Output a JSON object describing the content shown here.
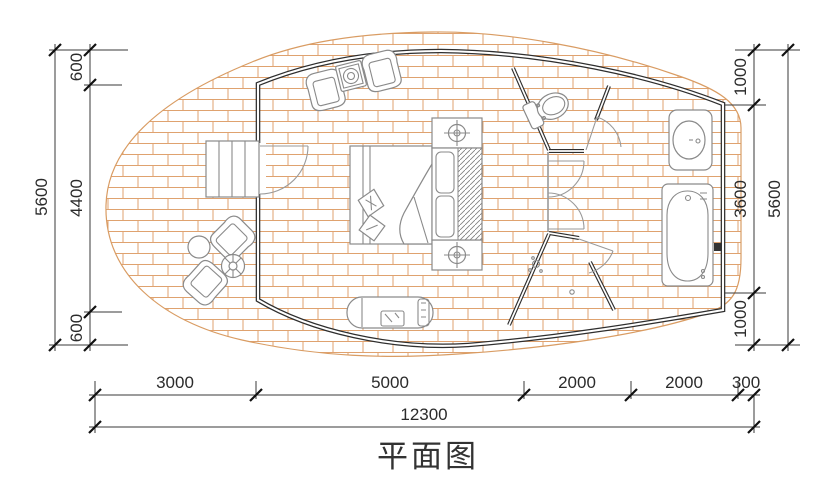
{
  "title": "平面图",
  "dims": {
    "left_total": "5600",
    "left_segments": [
      "600",
      "4400",
      "600"
    ],
    "right_segments": [
      "1000",
      "3600",
      "1000"
    ],
    "right_total": "5600",
    "bottom_segments": [
      "3000",
      "5000",
      "2000",
      "2000",
      "300"
    ],
    "bottom_total": "12300"
  },
  "colors": {
    "wall": "#2e2e2e",
    "deck_hatch": "#dfa26f",
    "furniture": "#8a8a8a",
    "dimension": "#2b2b2b",
    "background": "#ffffff"
  }
}
